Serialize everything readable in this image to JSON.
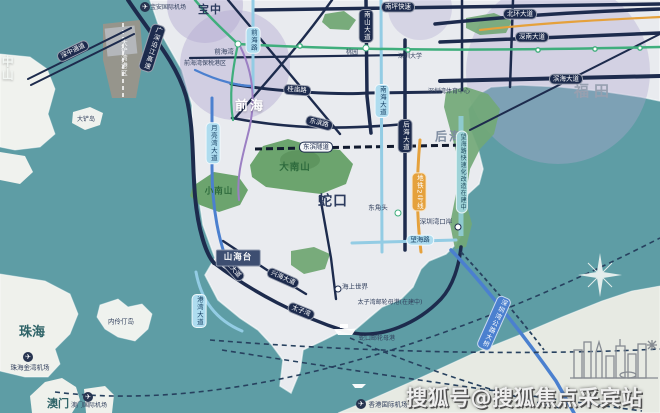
{
  "map": {
    "watermark": {
      "text": "搜狐号@搜狐焦点采宾站"
    },
    "icons": {
      "plane": "✈"
    },
    "colors": {
      "sea": "#5E9DA5",
      "land": "#E9EBEF",
      "hongkong_land": "#E7EAE3",
      "road_navy": "#1D2B4D",
      "road_blue": "#4B80CF",
      "road_lightblue": "#93CCE4",
      "metro_green": "#3FAE7C",
      "metro_orange": "#E5A13C",
      "metro_purple": "#9B7FC3",
      "mountain_green": "#6CA46E",
      "district_lavender": "#B1A8D0",
      "port_tan": "#9C958A"
    },
    "labels": [
      {
        "name": "region-zhongshan",
        "text": "中山",
        "x": 7,
        "y": 68,
        "cls": "sea-white v",
        "fs": 12
      },
      {
        "name": "region-zhuhai",
        "text": "珠海",
        "x": 32,
        "y": 333,
        "cls": "sea-dark",
        "fs": 13
      },
      {
        "name": "region-macau",
        "text": "澳门",
        "x": 58,
        "y": 404,
        "cls": "sea-dark",
        "fs": 11
      },
      {
        "name": "island-neilingding",
        "text": "内伶仃岛",
        "x": 121,
        "y": 322,
        "cls": "tiny-dark",
        "fs": 6.5
      },
      {
        "name": "island-dachan",
        "text": "大铲岛",
        "x": 86,
        "y": 120,
        "cls": "tiny-dark",
        "fs": 6
      },
      {
        "name": "region-qianhai",
        "text": "前海",
        "x": 250,
        "y": 107,
        "cls": "region-white",
        "fs": 13
      },
      {
        "name": "region-houhai",
        "text": "后海",
        "x": 449,
        "y": 137,
        "cls": "region-gray",
        "fs": 12
      },
      {
        "name": "region-shekou",
        "text": "蛇口",
        "x": 333,
        "y": 202,
        "cls": "region-navy",
        "fs": 14
      },
      {
        "name": "region-futian",
        "text": "福田",
        "x": 594,
        "y": 92,
        "cls": "region-fade",
        "fs": 15
      },
      {
        "name": "region-baozhong",
        "text": "宝中",
        "x": 210,
        "y": 10,
        "cls": "region-navy",
        "fs": 11
      },
      {
        "name": "mountain-dananshan",
        "text": "大南山",
        "x": 295,
        "y": 168,
        "cls": "green-label",
        "fs": 9.5
      },
      {
        "name": "mountain-xiaonanshan",
        "text": "小南山",
        "x": 219,
        "y": 192,
        "cls": "green-label",
        "fs": 8.5
      },
      {
        "name": "road-guangshen-riverside-expwy",
        "text": "广深沿江高速",
        "x": 152,
        "y": 48,
        "cls": "cap-navy v",
        "rot": 18
      },
      {
        "name": "road-nanping-expwy",
        "text": "南坪快速",
        "x": 398,
        "y": 7,
        "cls": "cap-navy"
      },
      {
        "name": "road-beihuan-blvd",
        "text": "北环大道",
        "x": 520,
        "y": 14,
        "cls": "cap-navy"
      },
      {
        "name": "road-shennan-blvd",
        "text": "深南大道",
        "x": 532,
        "y": 37,
        "cls": "cap-navy"
      },
      {
        "name": "road-binhai-blvd",
        "text": "滨海大道",
        "x": 566,
        "y": 79,
        "cls": "cap-navy"
      },
      {
        "name": "road-nanshan-blvd",
        "text": "南山大道",
        "x": 366,
        "y": 26,
        "cls": "cap-navy v"
      },
      {
        "name": "road-houhai-blvd",
        "text": "后海大道",
        "x": 405,
        "y": 136,
        "cls": "cap-navy v"
      },
      {
        "name": "road-guimiao-rd",
        "text": "桂庙路",
        "x": 297,
        "y": 90,
        "cls": "cap-navy",
        "rot": 4
      },
      {
        "name": "road-dongbin-rd",
        "text": "东滨路",
        "x": 319,
        "y": 123,
        "cls": "cap-navy",
        "rot": 14
      },
      {
        "name": "road-dongbin-tunnel",
        "text": "东滨隧道",
        "x": 316,
        "y": 147,
        "cls": "cap-white"
      },
      {
        "name": "road-xinghai-blvd",
        "text": "兴海大道",
        "x": 283,
        "y": 278,
        "cls": "cap-navy",
        "rot": 24
      },
      {
        "name": "road-gongye-blvd",
        "text": "工业大道",
        "x": 231,
        "y": 267,
        "cls": "cap-navy",
        "rot": 48
      },
      {
        "name": "road-taiziwan",
        "text": "太子湾",
        "x": 301,
        "y": 311,
        "cls": "cap-navy",
        "rot": 22
      },
      {
        "name": "road-gangwan-blvd",
        "text": "港湾大道",
        "x": 199,
        "y": 311,
        "cls": "cap-light v"
      },
      {
        "name": "road-nanhai-blvd",
        "text": "南海大道",
        "x": 382,
        "y": 101,
        "cls": "cap-light v"
      },
      {
        "name": "road-wanghai-rd",
        "text": "望海路",
        "x": 420,
        "y": 240,
        "cls": "cap-light"
      },
      {
        "name": "road-yueliangwan-blvd",
        "text": "月亮湾大道",
        "x": 213,
        "y": 143,
        "cls": "cap-light v"
      },
      {
        "name": "road-qianhai-rd",
        "text": "前海路",
        "x": 253,
        "y": 40,
        "cls": "cap-light v"
      },
      {
        "name": "road-wanghai-upgrade",
        "text": "望海路快速化改造在建中",
        "x": 462,
        "y": 172,
        "cls": "cap-teal v",
        "fs": 6
      },
      {
        "name": "metro-line2",
        "text": "地铁2号线",
        "x": 419,
        "y": 192,
        "cls": "cap-orange v"
      },
      {
        "name": "road-shenzhong-corridor",
        "text": "深中通道",
        "x": 73,
        "y": 51,
        "cls": "cap-navy",
        "rot": -26
      },
      {
        "name": "road-shenzhenwan-bridge",
        "text": "深圳湾公路大桥",
        "x": 494,
        "y": 323,
        "cls": "cap-blue v",
        "rot": 24
      },
      {
        "name": "port-dachanwan",
        "text": "大铲湾港区",
        "x": 123,
        "y": 58,
        "cls": "tiny-white v",
        "fs": 6.5
      },
      {
        "name": "poi-qianhaiwan-bonded-port",
        "text": "前海湾保税港区",
        "x": 205,
        "y": 64,
        "cls": "tiny-dark",
        "fs": 6
      },
      {
        "name": "poi-shenzhenwan-sports-center",
        "text": "深圳湾体育中心",
        "x": 449,
        "y": 92,
        "cls": "tiny-dark",
        "fs": 6
      },
      {
        "name": "poi-taiziwan-cruise-port",
        "text": "太子湾邮轮母港(在建中)",
        "x": 390,
        "y": 303,
        "cls": "tiny-dark",
        "fs": 6
      },
      {
        "name": "poi-shekou-cruise-port",
        "text": "蛇口邮轮母港",
        "x": 377,
        "y": 339,
        "cls": "tiny-dark",
        "fs": 6
      },
      {
        "name": "airport-hongkong",
        "text": "香港国际机场",
        "x": 388,
        "y": 405,
        "cls": "tiny-dark",
        "fs": 6.5
      },
      {
        "name": "airport-zhuhai-jinwan",
        "text": "珠海金湾机场",
        "x": 30,
        "y": 368,
        "cls": "tiny-dark",
        "fs": 6.5
      },
      {
        "name": "airport-macau",
        "text": "澳门国际机场",
        "x": 89,
        "y": 406,
        "cls": "tiny-dark",
        "fs": 6
      },
      {
        "name": "airport-baoan",
        "text": "宝安国际机场",
        "x": 168,
        "y": 8,
        "cls": "tiny-dark",
        "fs": 6
      },
      {
        "name": "project-shanhaitai",
        "text": "山海台",
        "x": 238,
        "y": 258,
        "cls": "block",
        "fs": 8.5
      },
      {
        "name": "poi-shenzhen-university",
        "text": "深圳大学",
        "x": 410,
        "y": 57,
        "cls": "tiny-dark",
        "fs": 6
      },
      {
        "name": "station-taoyuan-label",
        "text": "桃园",
        "x": 352,
        "y": 53,
        "cls": "tiny-dark",
        "fs": 6
      }
    ],
    "stations": [
      {
        "name": "station-qianhaiwan",
        "text": "前海湾",
        "x": 238,
        "y": 44,
        "lx": 224,
        "ly": 52,
        "ring": "#3FAE7C"
      },
      {
        "name": "station-taoyuan",
        "text": "",
        "x": 366,
        "y": 48,
        "lx": 0,
        "ly": 0,
        "ring": "#3FAE7C"
      },
      {
        "name": "station-dongjiaotou",
        "text": "东角头",
        "x": 398,
        "y": 213,
        "lx": 378,
        "ly": 208,
        "ring": "#3FAE7C"
      },
      {
        "name": "station-shenzhenwan-port",
        "text": "深圳湾口岸",
        "x": 458,
        "y": 227,
        "lx": 436,
        "ly": 222,
        "ring": "#1D2B4D"
      },
      {
        "name": "station-sea-world",
        "text": "海上世界",
        "x": 338,
        "y": 289,
        "lx": 355,
        "ly": 287,
        "ring": "#1D2B4D"
      }
    ],
    "planes": [
      {
        "name": "plane-icon-baoan",
        "x": 145,
        "y": 7
      },
      {
        "name": "plane-icon-zhuhai",
        "x": 28,
        "y": 357
      },
      {
        "name": "plane-icon-macau",
        "x": 88,
        "y": 397
      },
      {
        "name": "plane-icon-hongkong",
        "x": 361,
        "y": 404
      }
    ]
  }
}
